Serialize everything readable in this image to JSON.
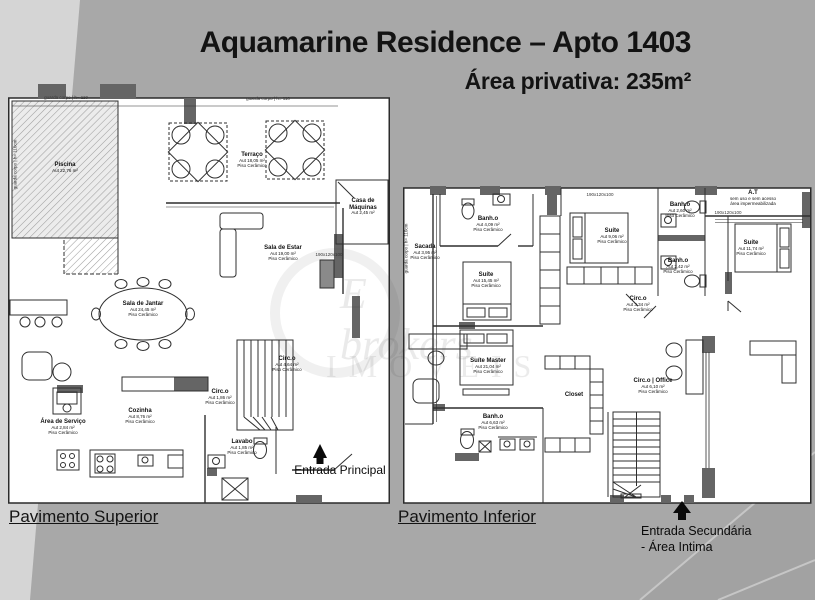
{
  "header": {
    "title": "Aquamarine Residence – Apto 1403",
    "subtitle": "Área privativa: 235m²"
  },
  "watermark": {
    "line1": "E brokers",
    "line2": "IMÓVEIS"
  },
  "colors": {
    "background": "#a8a8a8",
    "background_light": "#d5d5d5",
    "sheet": "#ffffff",
    "ink": "#1c1c1c",
    "wall": "#656565"
  },
  "plans": {
    "superior": {
      "caption": "Pavimento Superior",
      "entrance_label": "Entrada Principal",
      "notes": {
        "guard_top_left": "guarda corpo | h= 110",
        "guard_top_right": "guarda corpo | h= 110",
        "guard_side": "guarda corpo | h= 110cm",
        "dim_door": "190x120x100"
      },
      "rooms": [
        {
          "id": "piscina",
          "lines": [
            "Piscina",
            "Aut 22,76 m²"
          ]
        },
        {
          "id": "terraco",
          "lines": [
            "Terraço",
            "Aut 18,05 m²",
            "Piso Cerâmico"
          ]
        },
        {
          "id": "casa-de-maquinas",
          "lines": [
            "Casa de Máquinas",
            "Aut 2,45 m²"
          ]
        },
        {
          "id": "sala-de-estar",
          "lines": [
            "Sala de Estar",
            "Aut 19,00 m²",
            "Piso Cerâmico"
          ]
        },
        {
          "id": "sala-de-jantar",
          "lines": [
            "Sala de Jantar",
            "Aut 24,45 m²",
            "Piso Cerâmico"
          ]
        },
        {
          "id": "circ-escada",
          "lines": [
            "Circ.o",
            "Aut 4,64 m²",
            "Piso Cerâmico"
          ]
        },
        {
          "id": "circ",
          "lines": [
            "Circ.o",
            "Aut 1,86 m²",
            "Piso Cerâmico"
          ]
        },
        {
          "id": "cozinha",
          "lines": [
            "Cozinha",
            "Aut 8,76 m²",
            "Piso Cerâmico"
          ]
        },
        {
          "id": "area-de-servico",
          "lines": [
            "Área de Serviço",
            "Aut 2,84 m²",
            "Piso Cerâmico"
          ]
        },
        {
          "id": "lavabo",
          "lines": [
            "Lavabo",
            "Aut 1,85 m²",
            "Piso Cerâmico"
          ]
        }
      ]
    },
    "inferior": {
      "caption": "Pavimento Inferior",
      "entrance_line1": "Entrada Secundária",
      "entrance_line2": "- Área Intima",
      "notes": {
        "guard_side": "guarda corpo | h= 110cm",
        "dim_top": "190x120x100",
        "dim_at": "190x120x100"
      },
      "rooms": [
        {
          "id": "sacada",
          "lines": [
            "Sacada",
            "Aut 3,95 m²",
            "Piso Cerâmico"
          ]
        },
        {
          "id": "banho-1",
          "lines": [
            "Banh.o",
            "Aut 4,09 m²",
            "Piso Cerâmico"
          ]
        },
        {
          "id": "suite-1",
          "lines": [
            "Suíte",
            "Aut 15,45 m²",
            "Piso Cerâmico"
          ]
        },
        {
          "id": "suite-2",
          "lines": [
            "Suíte",
            "Aut 9,06 m²",
            "Piso Cerâmico"
          ]
        },
        {
          "id": "banho-2",
          "lines": [
            "Banh.o",
            "Aut 2,60 m²",
            "Piso Cerâmico"
          ]
        },
        {
          "id": "banho-3",
          "lines": [
            "Banh.o",
            "Aut 2,42 m²",
            "Piso Cerâmico"
          ]
        },
        {
          "id": "at",
          "lines": [
            "A.T",
            "sem uso e sem acesso",
            "área impermeabilizada"
          ]
        },
        {
          "id": "suite-3",
          "lines": [
            "Suíte",
            "Aut 11,74 m²",
            "Piso Cerâmico"
          ]
        },
        {
          "id": "circ",
          "lines": [
            "Circ.o",
            "Aut 3,34 m²",
            "Piso Cerâmico"
          ]
        },
        {
          "id": "suite-master",
          "lines": [
            "Suíte Master",
            "Aut 21,04 m²",
            "Piso Cerâmico"
          ]
        },
        {
          "id": "banho-master",
          "lines": [
            "Banh.o",
            "Aut 6,63 m²",
            "Piso Cerâmico"
          ]
        },
        {
          "id": "closet",
          "lines": [
            "Closet"
          ]
        },
        {
          "id": "circ-office",
          "lines": [
            "Circ.o | Office",
            "Aut 6,10 m²",
            "Piso Cerâmico"
          ]
        }
      ]
    }
  }
}
